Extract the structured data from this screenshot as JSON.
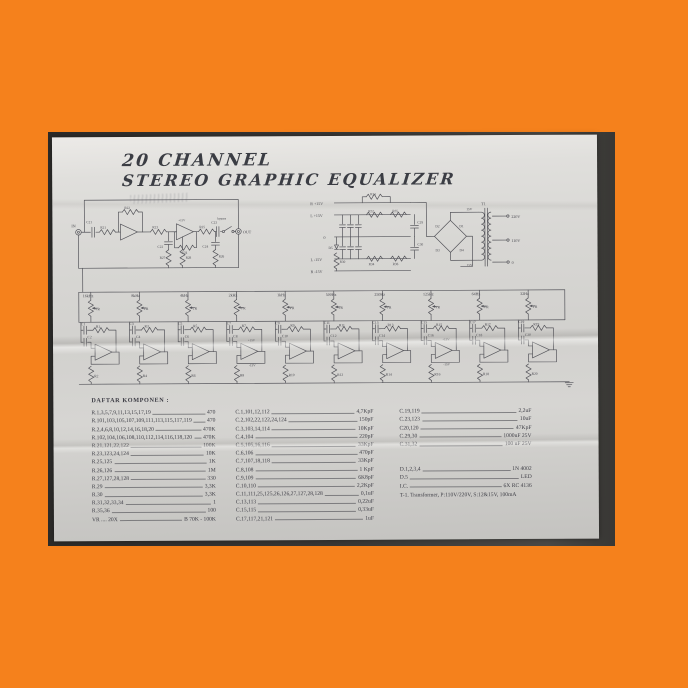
{
  "doc": {
    "title_line1": "20 CHANNEL",
    "title_line2": "STEREO GRAPHIC EQUALIZER"
  },
  "input_stage": {
    "in": "IN",
    "out": "OUT",
    "bypass": "bypass",
    "c21": "C21",
    "r21": "R21",
    "r22": "R22",
    "r23": "R23",
    "c22": "C22",
    "r24": "R24",
    "r25": "R25",
    "c23": "C23",
    "c24": "C24",
    "r26": "R26",
    "r27": "R27",
    "r28": "R28"
  },
  "psu": {
    "rails": [
      "R +15V",
      "L +15V",
      "0",
      "L -15V",
      "R -15V"
    ],
    "r31": "R31",
    "r32": "R32",
    "r35": "R35",
    "r34": "R34",
    "r36": "R36",
    "r30": "R30",
    "d5": "D5",
    "c29": "C29",
    "c30": "C30",
    "d": [
      "D1",
      "D2",
      "D3",
      "D4"
    ],
    "t1": "T1",
    "sec_top": "15V",
    "sec_bot": "15V",
    "tap_220": "220V",
    "tap_110": "110V",
    "tap_0": "0"
  },
  "filters": {
    "vr_label": "VR",
    "plus_rail": "+15V",
    "minus_rail": "-15V",
    "channels": [
      {
        "freq": "16kHz",
        "c_top": "C1",
        "r_top": "R1",
        "c_mid": "C2",
        "r_bot": "R2"
      },
      {
        "freq": "8kHz",
        "c_top": "C3",
        "r_top": "R3",
        "c_mid": "C4",
        "r_bot": "R4"
      },
      {
        "freq": "4kHz",
        "c_top": "C5",
        "r_top": "R5",
        "c_mid": "C6",
        "r_bot": "R6"
      },
      {
        "freq": "2kHz",
        "c_top": "C7",
        "r_top": "R7",
        "c_mid": "C8",
        "r_bot": "R8"
      },
      {
        "freq": "1kHz",
        "c_top": "C9",
        "r_top": "R9",
        "c_mid": "C10",
        "r_bot": "R10"
      },
      {
        "freq": "500Hz",
        "c_top": "C11",
        "r_top": "R11",
        "c_mid": "C12",
        "r_bot": "R12"
      },
      {
        "freq": "250Hz",
        "c_top": "C13",
        "r_top": "R13",
        "c_mid": "C14",
        "r_bot": "R14"
      },
      {
        "freq": "125Hz",
        "c_top": "C15",
        "r_top": "R15",
        "c_mid": "C16",
        "r_bot": "R16"
      },
      {
        "freq": "64Hz",
        "c_top": "C17",
        "r_top": "R17",
        "c_mid": "C18",
        "r_bot": "R18"
      },
      {
        "freq": "32Hz",
        "c_top": "C19",
        "r_top": "R19",
        "c_mid": "C20",
        "r_bot": "R20"
      }
    ]
  },
  "components": {
    "heading": "DAFTAR KOMPONEN :",
    "col1": [
      {
        "d": "R.1,3,5,7,9,11,13,15,17,19",
        "v": "470"
      },
      {
        "d": "R.101,103,105,107,109,111,113,115,117,119",
        "v": "470"
      },
      {
        "d": "R.2,4,6,8,10,12,14,16,18,20",
        "v": "470K"
      },
      {
        "d": "R.102,104,106,108,110,112,114,116,118,120",
        "v": "470K"
      },
      {
        "d": "R.21,121,22,122",
        "v": "100K"
      },
      {
        "d": "R.23,123,24,124",
        "v": "10K"
      },
      {
        "d": "R.25,125",
        "v": "1K"
      },
      {
        "d": "R.26,126",
        "v": "1M"
      },
      {
        "d": "R.27,127,28,128",
        "v": "330"
      },
      {
        "d": "R.29",
        "v": "3,3K"
      },
      {
        "d": "R.30",
        "v": "3,3K"
      },
      {
        "d": "R.31,32,33,34",
        "v": "1"
      },
      {
        "d": "R.35,36",
        "v": "100"
      },
      {
        "d": "VR .... 20X",
        "v": "B 70K - 100K"
      }
    ],
    "col2": [
      {
        "d": "C.1,101,12,112",
        "v": "4,7KpF"
      },
      {
        "d": "C.2,102,22,122,24,124",
        "v": "150pF"
      },
      {
        "d": "C.3,103,14,114",
        "v": "10KpF"
      },
      {
        "d": "C.4,104",
        "v": "220pF"
      },
      {
        "d": "C.5,105,16,116",
        "v": "33KpF"
      },
      {
        "d": "C.6,106",
        "v": "470pF"
      },
      {
        "d": "C.7,107,18,118",
        "v": "33KpF"
      },
      {
        "d": "C.8,108",
        "v": "1 KpF"
      },
      {
        "d": "C.9,109",
        "v": "6K8pF"
      },
      {
        "d": "C.10,110",
        "v": "2,2KpF"
      },
      {
        "d": "C.11,111,25,125,26,126,27,127,28,128",
        "v": "0,1uF"
      },
      {
        "d": "C.13,113",
        "v": "0,22uF"
      },
      {
        "d": "C.15,115",
        "v": "0,33uF"
      },
      {
        "d": "C.17,117,21,121",
        "v": "1uF"
      }
    ],
    "col3a": [
      {
        "d": "C.19,119",
        "v": "2,2uF"
      },
      {
        "d": "C.23,123",
        "v": "10uF"
      },
      {
        "d": "C20,120",
        "v": "47KpF"
      },
      {
        "d": "C.29,30",
        "v": "1000uF 25V"
      },
      {
        "d": "C.31,32",
        "v": "100 uF 25V"
      }
    ],
    "col3b": [
      {
        "d": "D.1,2,3,4",
        "v": "1N 4002"
      },
      {
        "d": "D.5",
        "v": "LED"
      },
      {
        "d": "I.C.",
        "v": "6X RC 4136"
      }
    ],
    "transformer_line": "T-1. Transformer,  P:110V/220V,  S:12&15V,  100mA"
  }
}
